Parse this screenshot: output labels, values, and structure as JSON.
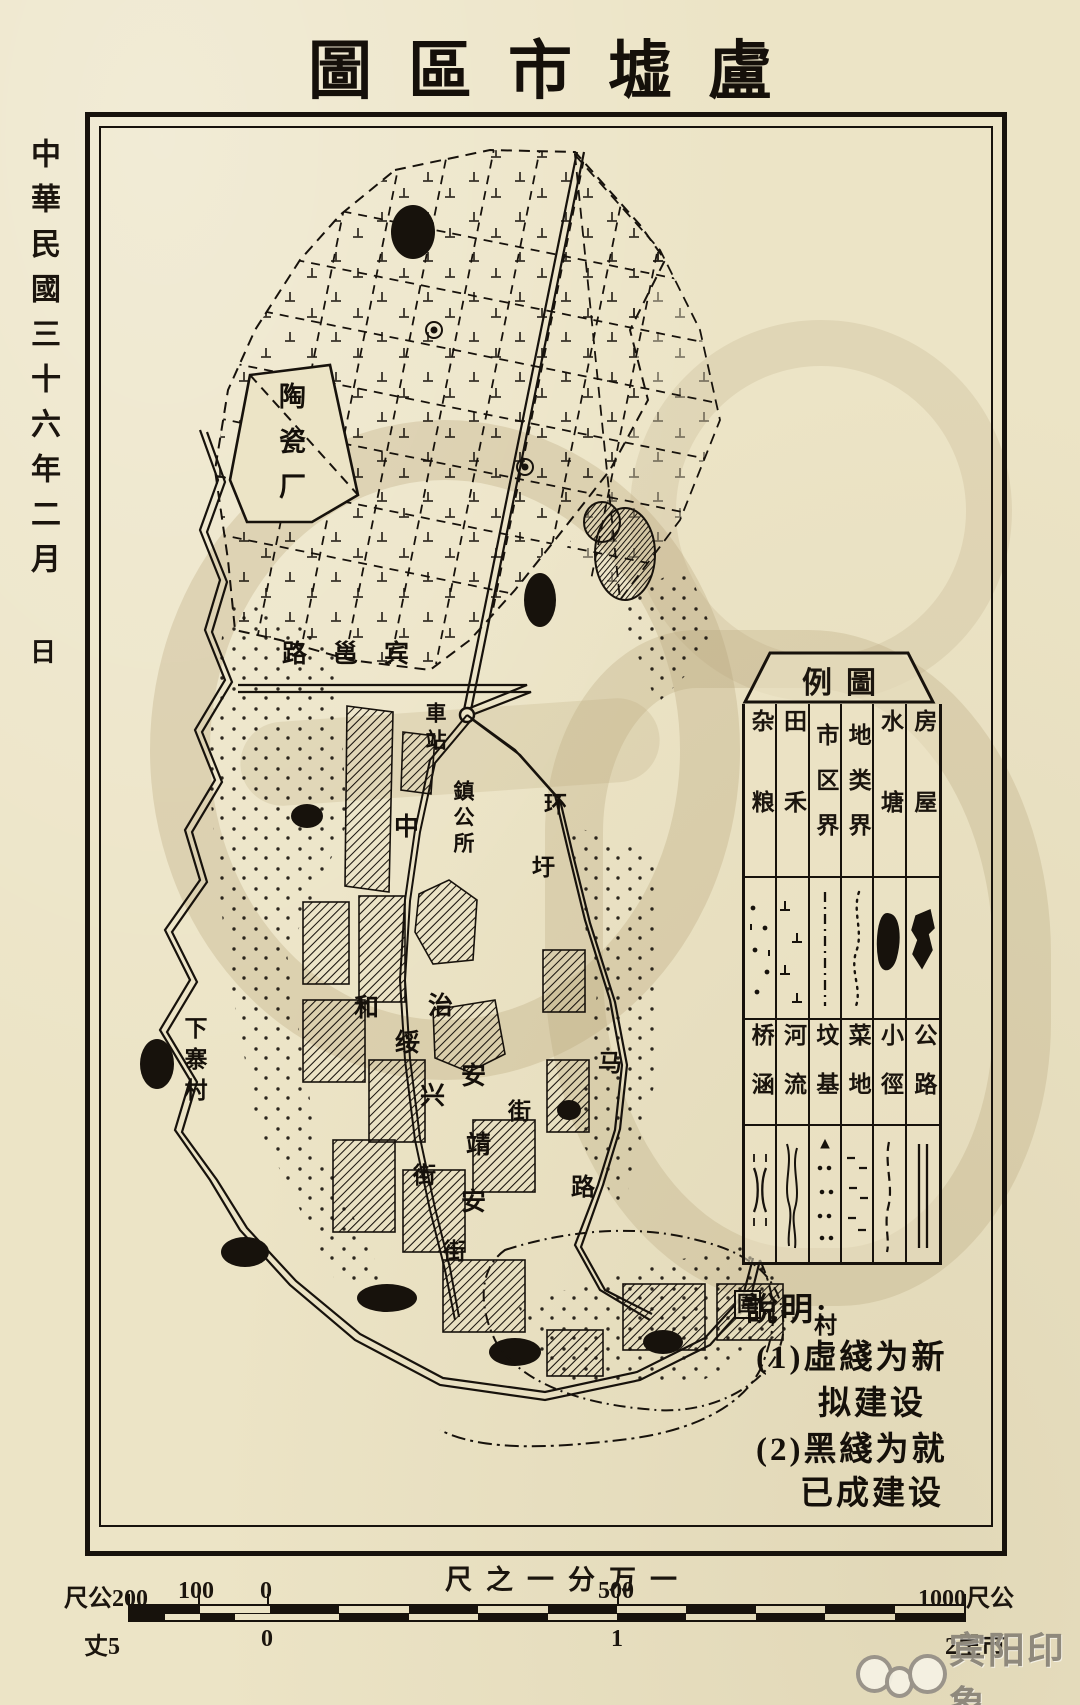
{
  "title": "圖區市墟盧",
  "date_sidebar": {
    "line1": "中華民國三十六年二月",
    "line2": "日"
  },
  "legend": {
    "header": "例圖",
    "top_row": [
      {
        "label": "杂粮",
        "symbol": "scattered-dots"
      },
      {
        "label": "田禾",
        "symbol": "rice-marks"
      },
      {
        "label": "市区界",
        "symbol": "dash-dot-line"
      },
      {
        "label": "地类界",
        "symbol": "dotted-wavy-line"
      },
      {
        "label": "水塘",
        "symbol": "hatched-pond"
      },
      {
        "label": "房屋",
        "symbol": "hatched-building"
      }
    ],
    "bottom_row": [
      {
        "label": "桥涵",
        "symbol": "bridge-marks"
      },
      {
        "label": "河流",
        "symbol": "stream-lines"
      },
      {
        "label": "坟基",
        "symbol": "grave-dots"
      },
      {
        "label": "菜地",
        "symbol": "dash-marks"
      },
      {
        "label": "小徑",
        "symbol": "dashed-path"
      },
      {
        "label": "公路",
        "symbol": "double-line-road"
      }
    ]
  },
  "notes": {
    "heading": "說明:",
    "line1": "(1)虛綫为新",
    "line2": "拟建设",
    "line3": "(2)黑綫为就",
    "line4": "已成建设"
  },
  "scale": {
    "title": "尺之一分万一",
    "top_labels": [
      "尺公200",
      "100",
      "0",
      "500",
      "1000尺公"
    ],
    "bottom_labels": [
      "丈5",
      "0",
      "1",
      "2里市"
    ]
  },
  "map_labels": {
    "factory": "陶瓷厂",
    "road_binyong": "路邕宾",
    "station": "車站",
    "town_office": "鎮公所",
    "char_zhong": "中",
    "ring_huan": "环",
    "ring_xu": "圩",
    "ring_ma": "马",
    "ring_lu": "路",
    "street_he": "和",
    "street_zhi": "治",
    "street_sui": "绥",
    "street_an1": "安",
    "street_xing": "兴",
    "street_jie1": "街",
    "street_jing": "靖",
    "street_jie2": "街",
    "street_an2": "安",
    "street_jie3": "街",
    "village_xiazhai": "下寨村",
    "village_wei": "圍",
    "village_cun": "村"
  },
  "watermark": {
    "text": "宾阳印象"
  }
}
